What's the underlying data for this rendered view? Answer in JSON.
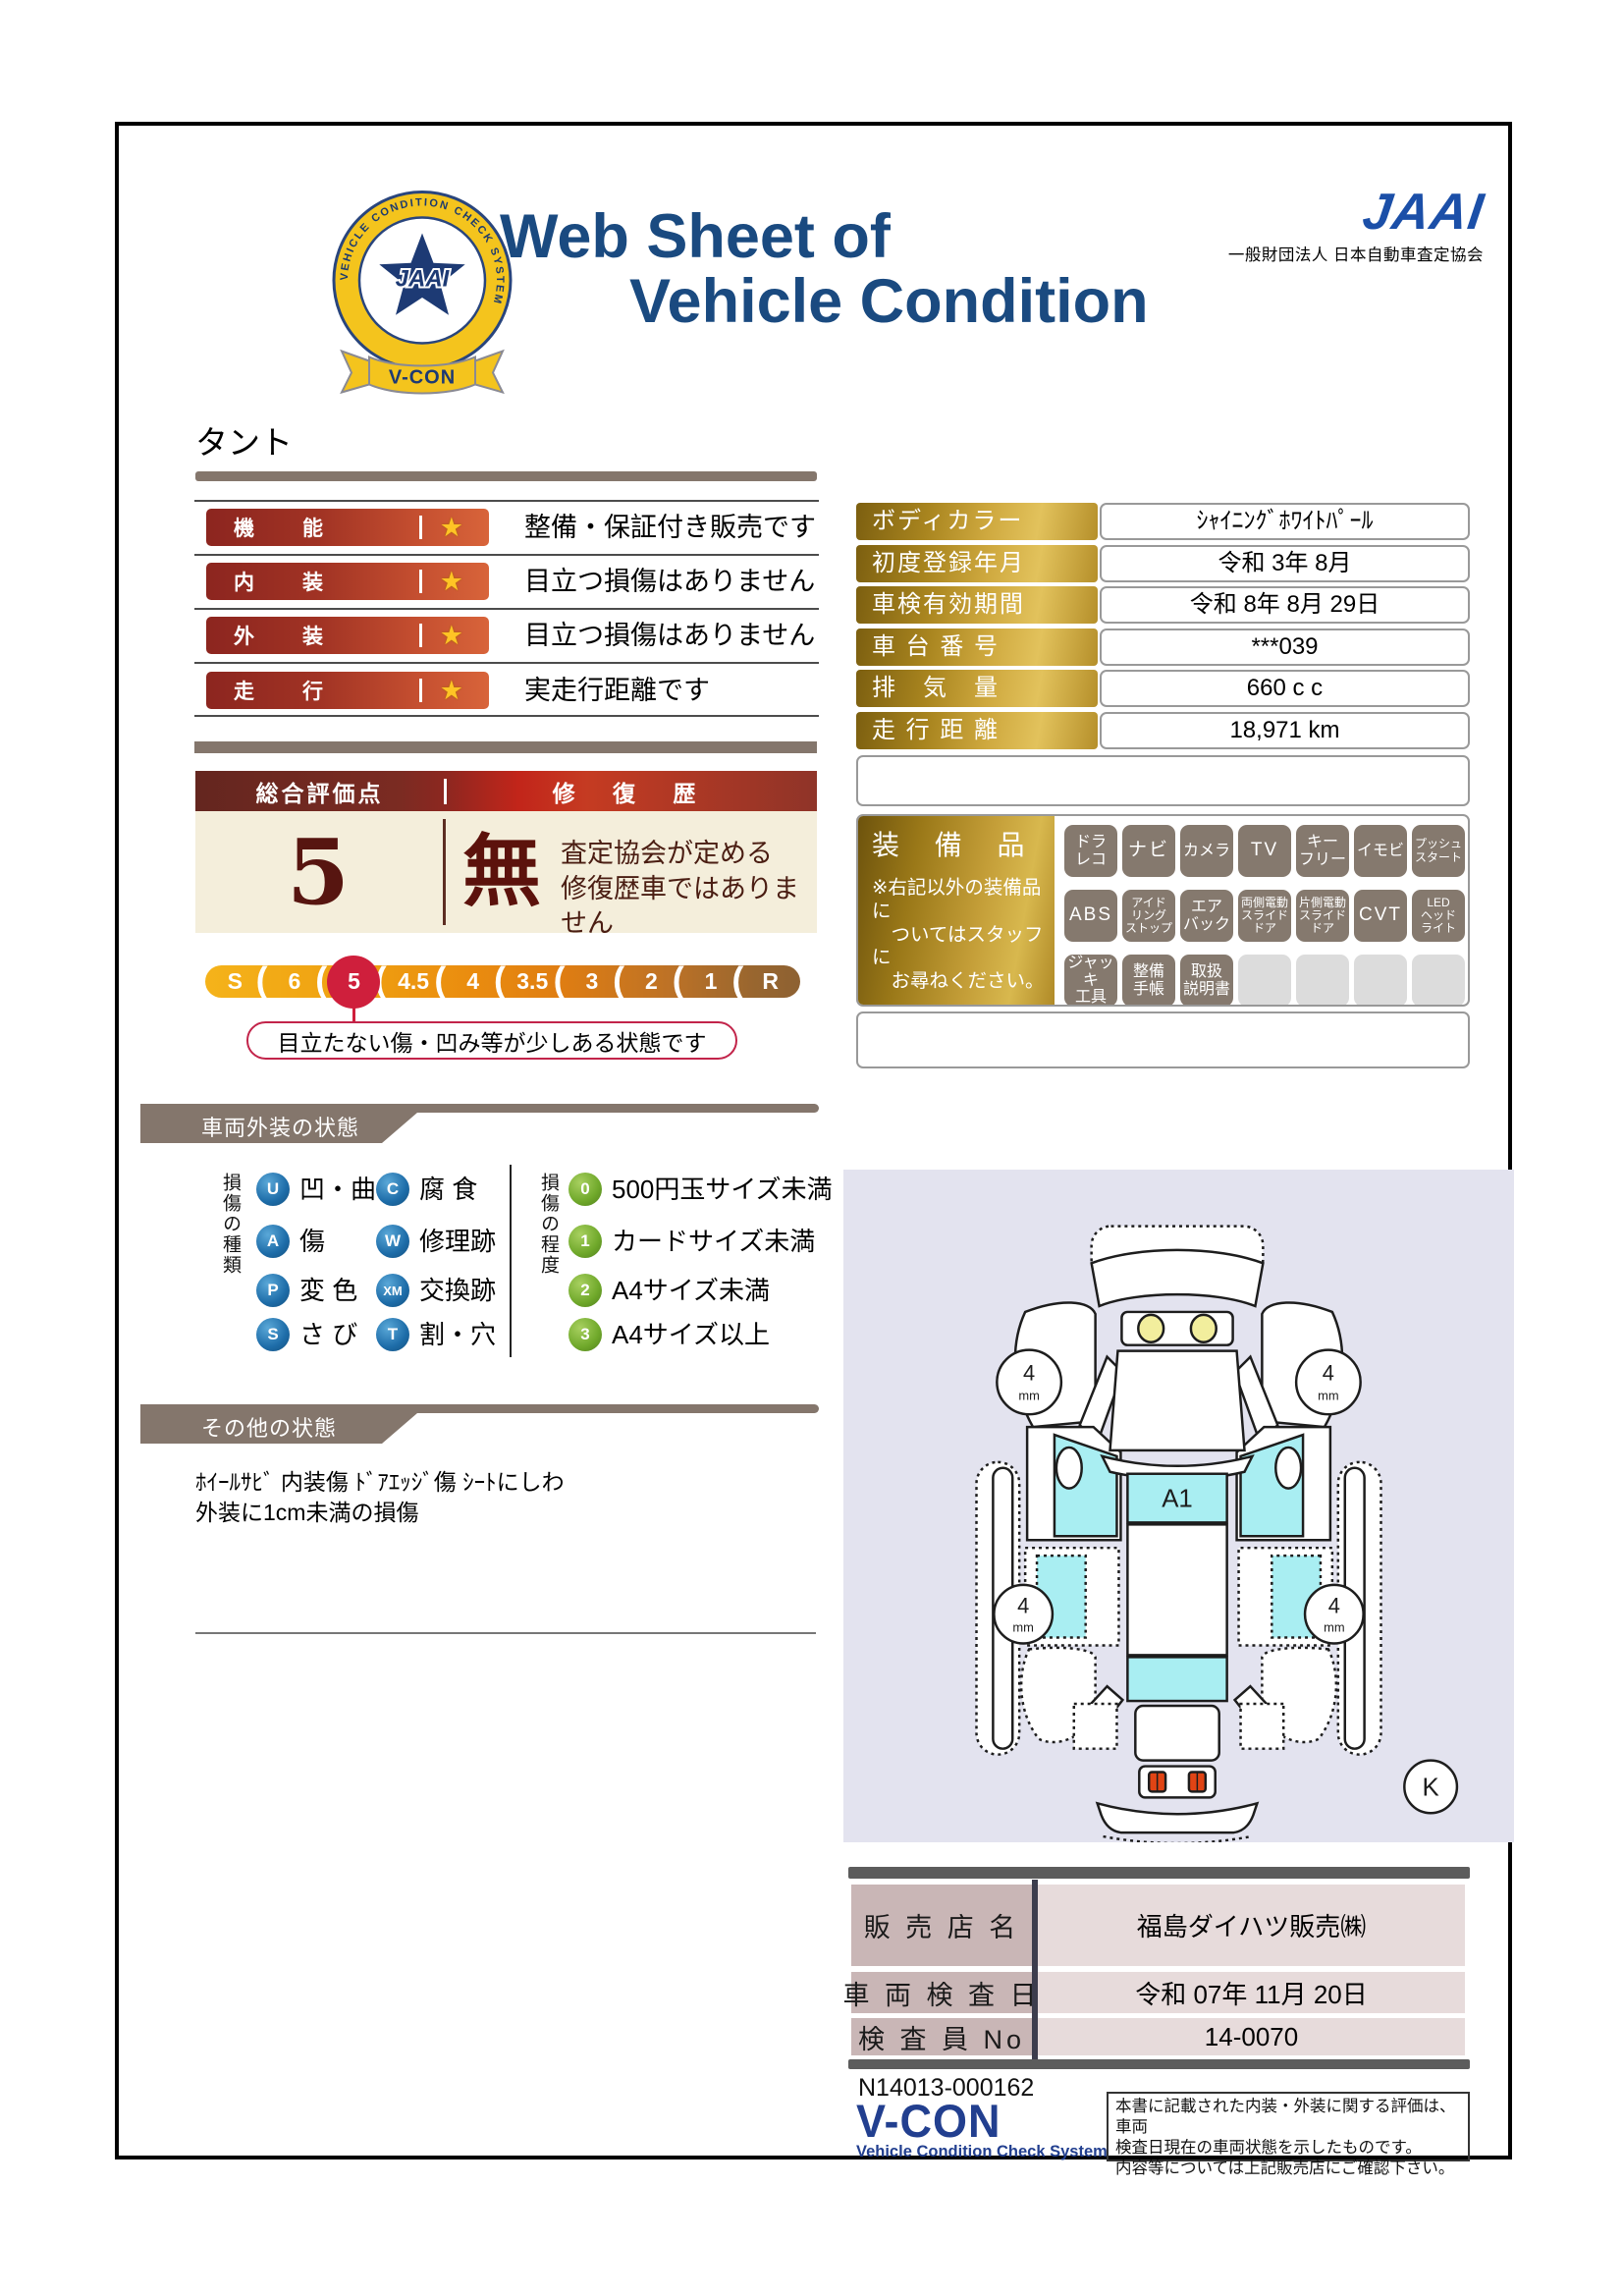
{
  "header": {
    "title_line1": "Web Sheet of",
    "title_line2": "Vehicle Condition",
    "org_logo": "JAAI",
    "org_name": "一般財団法人 日本自動車査定協会",
    "badge": {
      "ring_text": "VEHICLE CONDITION CHECK SYSTEM",
      "center": "JAAI",
      "ribbon": "V-CON"
    }
  },
  "vehicle_name": "タント",
  "icons": {
    "star": "★"
  },
  "ratings": [
    {
      "label": "機　能",
      "description": "整備・保証付き販売です"
    },
    {
      "label": "内　装",
      "description": "目立つ損傷はありません"
    },
    {
      "label": "外　装",
      "description": "目立つ損傷はありません"
    },
    {
      "label": "走　行",
      "description": "実走行距離です"
    }
  ],
  "overall": {
    "score_label": "総合評価点",
    "score": "5",
    "repair_label": "修 復 歴",
    "repair_value": "無",
    "repair_note_line1": "査定協会が定める",
    "repair_note_line2": "修復歴車ではありません"
  },
  "scale": {
    "segments": [
      "S",
      "6",
      "5",
      "4.5",
      "4",
      "3.5",
      "3",
      "2",
      "1",
      "R"
    ],
    "selected": "5",
    "callout": "目立たない傷・凹み等が少しある状態です"
  },
  "info_table": {
    "rows": [
      {
        "label": "ボディカラー",
        "value": "ｼｬｲﾆﾝｸﾞﾎﾜｲﾄﾊﾟｰﾙ"
      },
      {
        "label": "初度登録年月",
        "value": "令和 3年 8月"
      },
      {
        "label": "車検有効期間",
        "value": "令和 8年 8月 29日"
      },
      {
        "label": "車 台 番 号",
        "value": "***039"
      },
      {
        "label": "排　気　量",
        "value": "660 c c"
      },
      {
        "label": "走 行 距 離",
        "value": "18,971 km"
      }
    ]
  },
  "equipment": {
    "title": "装 備 品",
    "note": "※右記以外の装備品に\n　ついてはスタッフに\n　お尋ねください。",
    "badges": [
      {
        "label": "ドラ\nレコ"
      },
      {
        "label": "ナビ"
      },
      {
        "label": "カメラ"
      },
      {
        "label": "TV"
      },
      {
        "label": "キー\nフリー"
      },
      {
        "label": "イモビ"
      },
      {
        "label": "プッシュ\nスタート"
      },
      {
        "label": "ABS"
      },
      {
        "label": "アイド\nリング\nストップ"
      },
      {
        "label": "エア\nバック"
      },
      {
        "label": "両側電動\nスライド\nドア"
      },
      {
        "label": "片側電動\nスライド\nドア"
      },
      {
        "label": "CVT"
      },
      {
        "label": "LED\nヘッド\nライト"
      },
      {
        "label": "ジャッキ\n工具"
      },
      {
        "label": "整備\n手帳"
      },
      {
        "label": "取扱\n説明書"
      },
      {
        "label": ""
      },
      {
        "label": ""
      },
      {
        "label": ""
      },
      {
        "label": ""
      }
    ]
  },
  "exterior_section": {
    "title": "車両外装の状態",
    "type_label": "損傷の種類",
    "degree_label": "損傷の程度",
    "damage_types": [
      {
        "code": "U",
        "label": "凹・曲"
      },
      {
        "code": "C",
        "label": "腐 食"
      },
      {
        "code": "A",
        "label": "傷"
      },
      {
        "code": "W",
        "label": "修理跡"
      },
      {
        "code": "P",
        "label": "変 色"
      },
      {
        "code": "XM",
        "label": "交換跡"
      },
      {
        "code": "S",
        "label": "さ び"
      },
      {
        "code": "T",
        "label": "割・穴"
      }
    ],
    "damage_degrees": [
      {
        "code": "0",
        "label": "500円玉サイズ未満"
      },
      {
        "code": "1",
        "label": "カードサイズ未満"
      },
      {
        "code": "2",
        "label": "A4サイズ未満"
      },
      {
        "code": "3",
        "label": "A4サイズ以上"
      }
    ]
  },
  "other_section": {
    "title": "その他の状態",
    "line1": "ﾎｲｰﾙｻﾋﾞ 内装傷 ﾄﾞｱｴｯｼﾞ傷 ｼｰﾄにしわ",
    "line2": "外装に1cm未満の損傷"
  },
  "diagram": {
    "damage_mark": "A1",
    "tire_depths": [
      "4",
      "4",
      "4",
      "4"
    ],
    "tire_unit": "mm",
    "corner_label": "K"
  },
  "dealer_table": {
    "rows": [
      {
        "label": "販 売 店 名",
        "value": "福島ダイハツ販売㈱"
      },
      {
        "label": "車 両 検 査 日",
        "value": "令和 07年 11月 20日"
      },
      {
        "label": "検 査 員 No",
        "value": "14-0070"
      }
    ]
  },
  "footer": {
    "sheet_no": "N14013-000162",
    "vcon_logo": "V-CON",
    "vcon_sub": "Vehicle Condition Check System",
    "disclaimer_line1": "本書に記載された内装・外装に関する評価は、車両",
    "disclaimer_line2": "検査日現在の車両状態を示したものです。",
    "disclaimer_line3": "内容等については上記販売店にご確認下さい。"
  },
  "colors": {
    "title_navy": "#1a4a80",
    "jaai_blue": "#1b4fa8",
    "section_taupe": "#84766c",
    "rating_bar_red": "#8c251f",
    "star_gold": "#ffc425",
    "score_maroon": "#571510",
    "scale_selected_red": "#cf1f3c",
    "info_gold": "#cfa93f",
    "badge_gray": "#85796e",
    "glass_cyan": "#a9eef2",
    "diagram_bg": "#e3e3ef",
    "dealer_pink": "#c9b6b6",
    "vcon_navy": "#223f8f"
  }
}
